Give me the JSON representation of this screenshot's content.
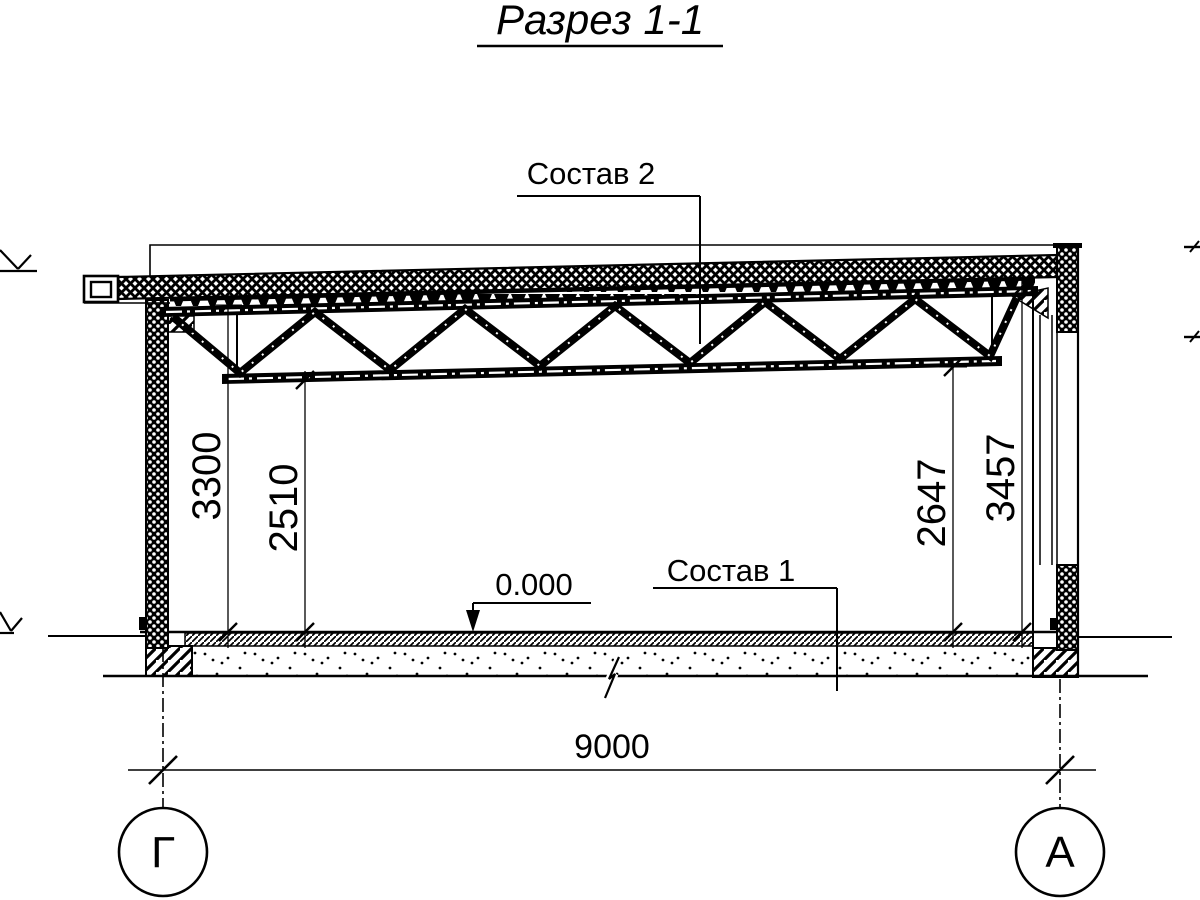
{
  "title": {
    "text": "Разрез 1-1"
  },
  "callouts": {
    "roof_composition": "Состав 2",
    "floor_composition": "Состав 1",
    "floor_elevation": "0.000"
  },
  "dimensions": {
    "left_outer": "3300",
    "left_inner": "2510",
    "right_inner": "2647",
    "right_outer": "3457",
    "span": "9000"
  },
  "axis_markers": {
    "left": "Г",
    "right": "А"
  },
  "colors": {
    "ink": "#000000",
    "paper": "#ffffff"
  }
}
